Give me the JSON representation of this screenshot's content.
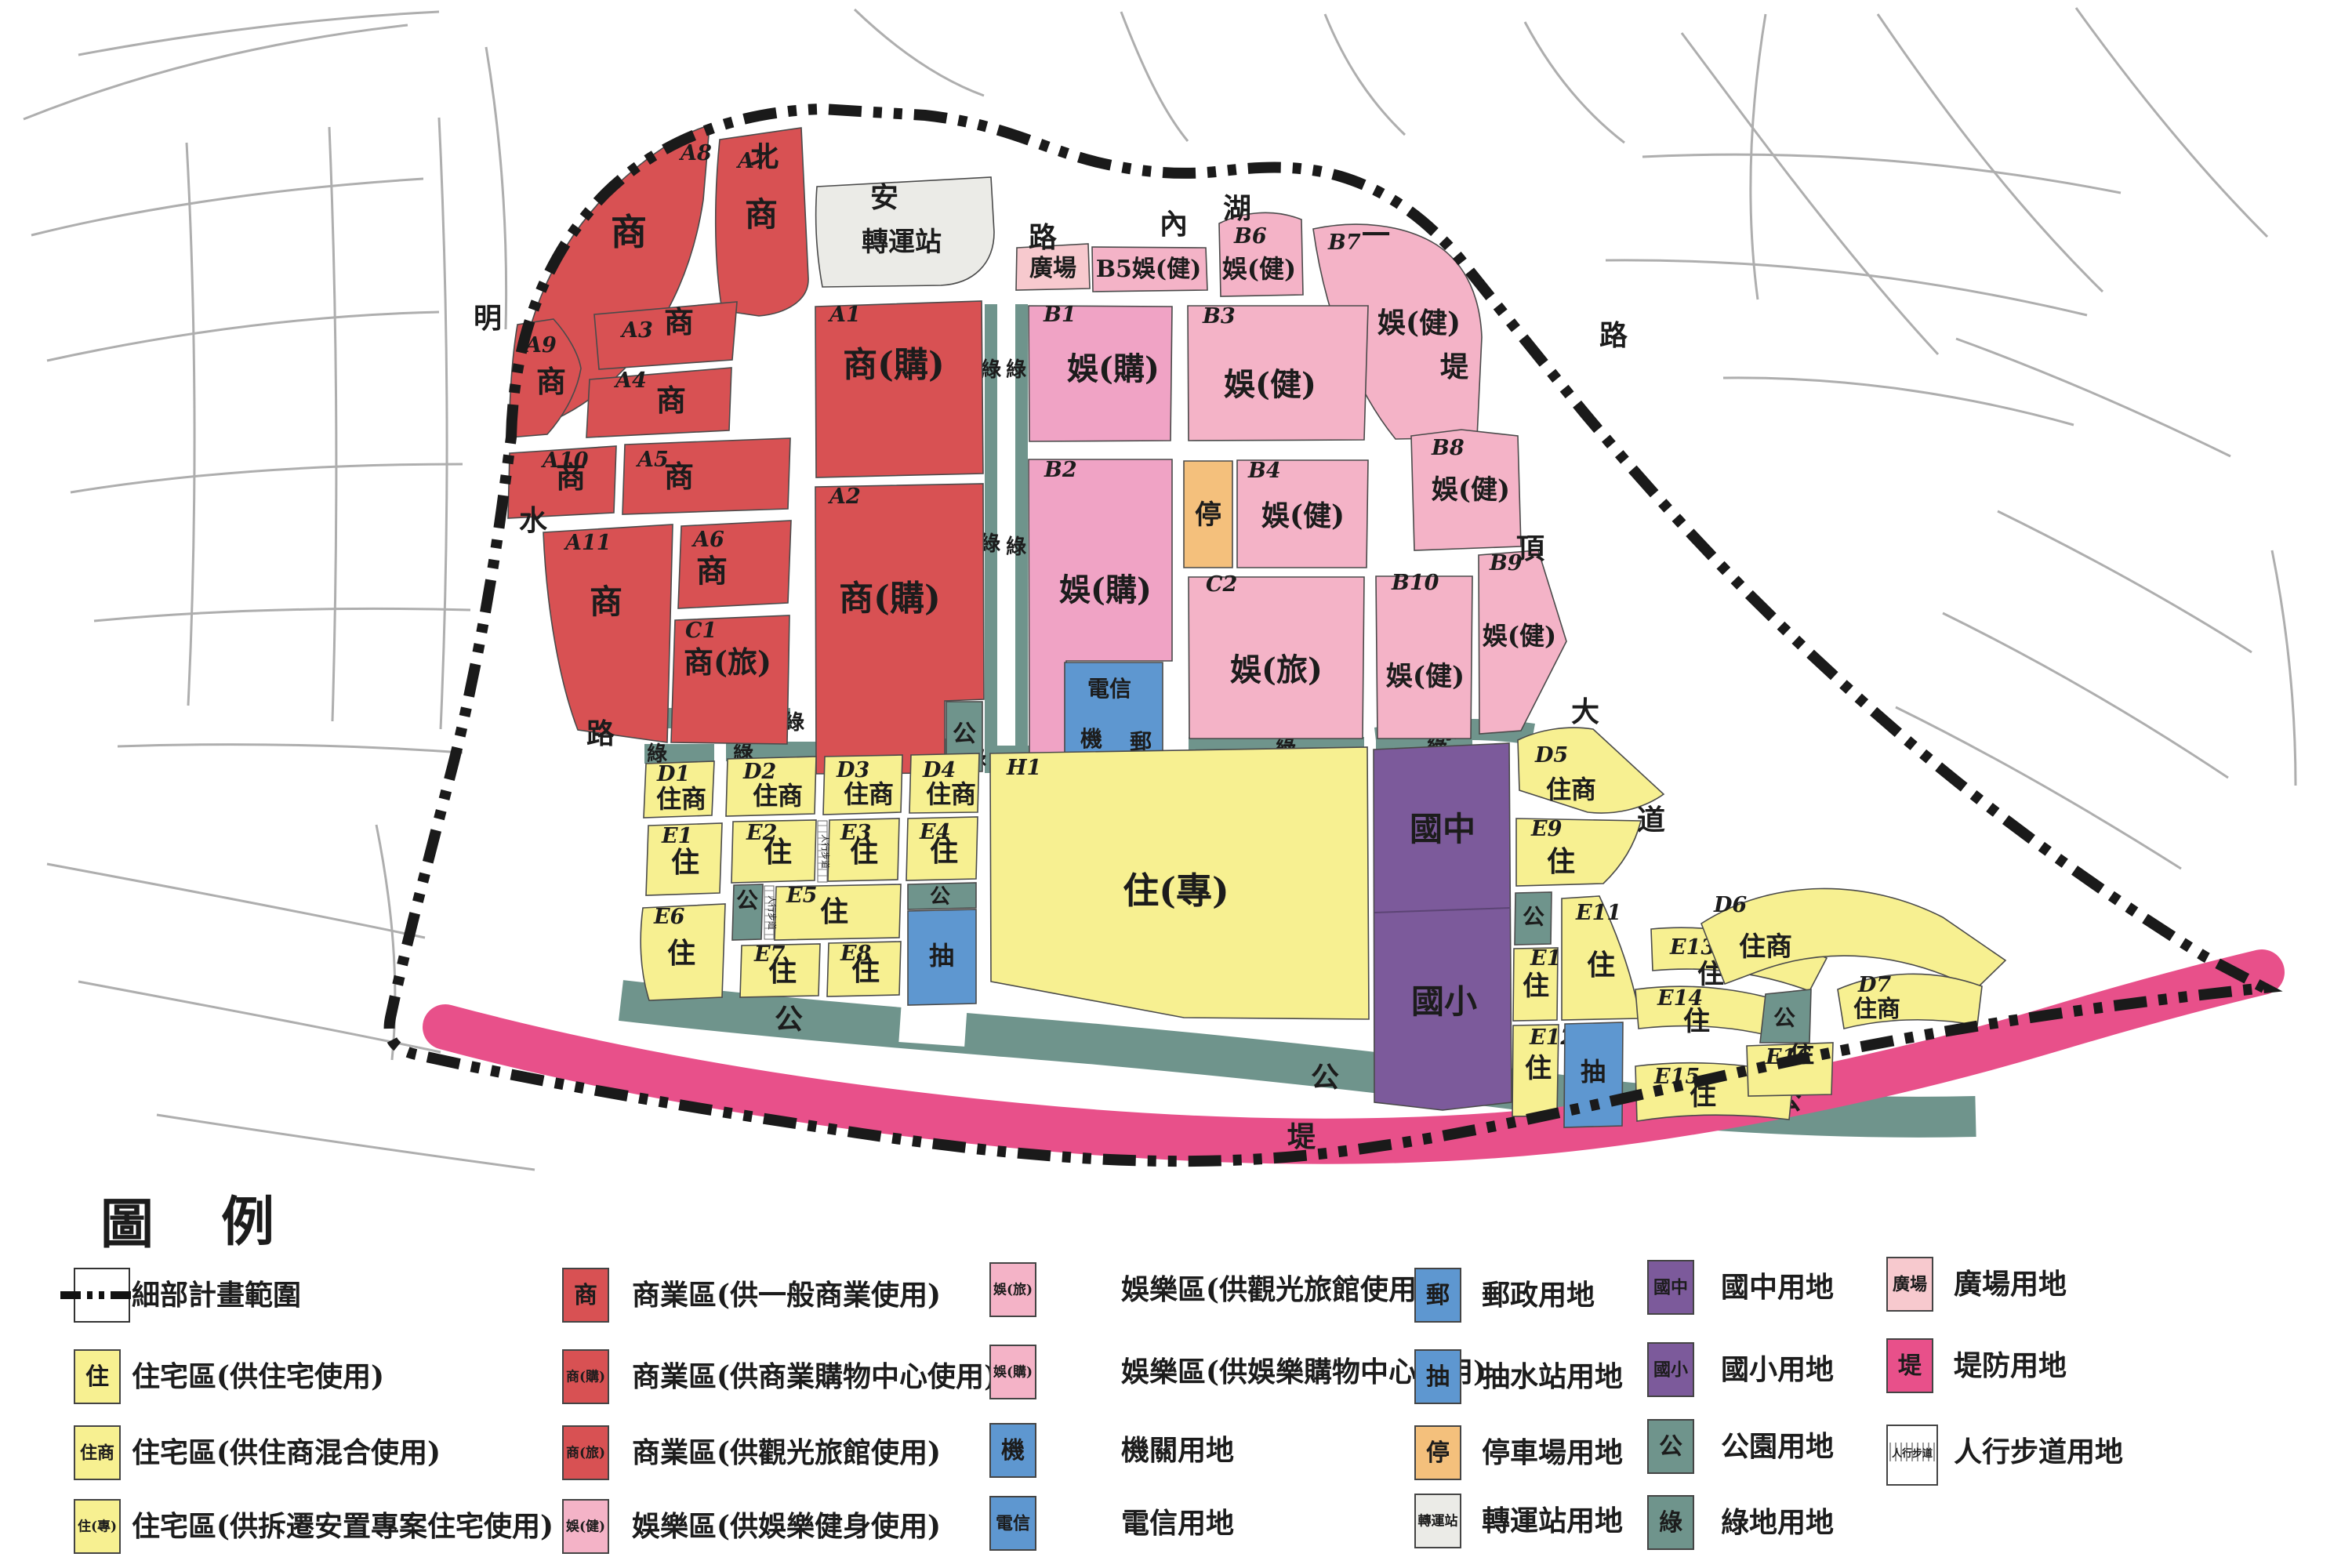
{
  "colors": {
    "commercial": "#d85153",
    "entertainment": "#f4b3c7",
    "entshop": "#f0a3c5",
    "plaza": "#f7c9ce",
    "residential": "#f7f091",
    "school": "#7c5a9b",
    "institution": "#5e97d0",
    "parking": "#f4c07c",
    "park": "#6f948c",
    "green": "#6f948c",
    "levee": "#e8508a",
    "station": "#ebebe7",
    "boundary": "#1a1a1a",
    "street": "#aeaeae"
  },
  "map": {
    "zones": [
      {
        "key": "A8",
        "id": "A8",
        "label": "商",
        "kind": "commercial"
      },
      {
        "key": "A7",
        "id": "A7",
        "label": "商",
        "kind": "commercial"
      },
      {
        "key": "A3",
        "id": "A3",
        "label": "商",
        "kind": "commercial"
      },
      {
        "key": "A9",
        "id": "A9",
        "label": "商",
        "kind": "commercial"
      },
      {
        "key": "A4",
        "id": "A4",
        "label": "商",
        "kind": "commercial"
      },
      {
        "key": "A10",
        "id": "A10",
        "label": "商",
        "kind": "commercial"
      },
      {
        "key": "A5",
        "id": "A5",
        "label": "商",
        "kind": "commercial"
      },
      {
        "key": "A11",
        "id": "A11",
        "label": "商",
        "kind": "commercial"
      },
      {
        "key": "A6",
        "id": "A6",
        "label": "商",
        "kind": "commercial"
      },
      {
        "key": "C1",
        "id": "C1",
        "label": "商(旅)",
        "kind": "commercial"
      },
      {
        "key": "A1",
        "id": "A1",
        "label": "商(購)",
        "kind": "commercial"
      },
      {
        "key": "A2",
        "id": "A2",
        "label": "商(購)",
        "kind": "commercial"
      },
      {
        "key": "ZS",
        "id": "",
        "label": "轉運站",
        "kind": "station"
      },
      {
        "key": "GC",
        "id": "",
        "label": "廣場",
        "kind": "plaza"
      },
      {
        "key": "B5",
        "id": "",
        "label": "B5娛(健)",
        "kind": "entertainment"
      },
      {
        "key": "B6",
        "id": "B6",
        "label": "娛(健)",
        "kind": "entertainment"
      },
      {
        "key": "B7",
        "id": "B7",
        "label": "娛(健)",
        "kind": "entertainment"
      },
      {
        "key": "B1",
        "id": "B1",
        "label": "娛(購)",
        "kind": "entshop"
      },
      {
        "key": "B3",
        "id": "B3",
        "label": "娛(健)",
        "kind": "entertainment"
      },
      {
        "key": "B2",
        "id": "B2",
        "label": "娛(購)",
        "kind": "entshop"
      },
      {
        "key": "P1",
        "id": "",
        "label": "停",
        "kind": "parking"
      },
      {
        "key": "B4",
        "id": "B4",
        "label": "娛(健)",
        "kind": "entertainment"
      },
      {
        "key": "B8",
        "id": "B8",
        "label": "娛(健)",
        "kind": "entertainment"
      },
      {
        "key": "C2",
        "id": "C2",
        "label": "娛(旅)",
        "kind": "entertainment"
      },
      {
        "key": "B10",
        "id": "B10",
        "label": "娛(健)",
        "kind": "entertainment"
      },
      {
        "key": "B9",
        "id": "B9",
        "label": "娛(健)",
        "kind": "entertainment"
      },
      {
        "key": "TEL",
        "id": "",
        "label": "電信",
        "label2": "機",
        "label3": "郵",
        "kind": "institution"
      },
      {
        "key": "PK1",
        "id": "",
        "label": "公",
        "kind": "park"
      },
      {
        "key": "SCH",
        "id": "",
        "label": "國中",
        "label2": "國小",
        "kind": "school"
      },
      {
        "key": "H1",
        "id": "H1",
        "label": "住(專)",
        "kind": "residential"
      },
      {
        "key": "D1",
        "id": "D1",
        "label": "住商",
        "kind": "residential"
      },
      {
        "key": "D2",
        "id": "D2",
        "label": "住商",
        "kind": "residential"
      },
      {
        "key": "D3",
        "id": "D3",
        "label": "住商",
        "kind": "residential"
      },
      {
        "key": "D4",
        "id": "D4",
        "label": "住商",
        "kind": "residential"
      },
      {
        "key": "E1",
        "id": "E1",
        "label": "住",
        "kind": "residential"
      },
      {
        "key": "E2",
        "id": "E2",
        "label": "住",
        "kind": "residential"
      },
      {
        "key": "E3",
        "id": "E3",
        "label": "住",
        "kind": "residential"
      },
      {
        "key": "E4",
        "id": "E4",
        "label": "住",
        "kind": "residential"
      },
      {
        "key": "PK2",
        "id": "",
        "label": "公",
        "kind": "park"
      },
      {
        "key": "E5",
        "id": "E5",
        "label": "住",
        "kind": "residential"
      },
      {
        "key": "E6",
        "id": "E6",
        "label": "住",
        "kind": "residential"
      },
      {
        "key": "E7",
        "id": "E7",
        "label": "住",
        "kind": "residential"
      },
      {
        "key": "E8",
        "id": "E8",
        "label": "住",
        "kind": "residential"
      },
      {
        "key": "PK3",
        "id": "",
        "label": "公",
        "kind": "park"
      },
      {
        "key": "CH1",
        "id": "",
        "label": "抽",
        "kind": "institution"
      },
      {
        "key": "D5",
        "id": "D5",
        "label": "住商",
        "kind": "residential"
      },
      {
        "key": "E9",
        "id": "E9",
        "label": "住",
        "kind": "residential"
      },
      {
        "key": "PK4",
        "id": "",
        "label": "公",
        "kind": "park"
      },
      {
        "key": "E10",
        "id": "E10",
        "label": "住",
        "kind": "residential"
      },
      {
        "key": "E11",
        "id": "E11",
        "label": "住",
        "kind": "residential"
      },
      {
        "key": "E12",
        "id": "E12",
        "label": "住",
        "kind": "residential"
      },
      {
        "key": "CH2",
        "id": "",
        "label": "抽",
        "kind": "institution"
      },
      {
        "key": "E13",
        "id": "E13",
        "label": "住",
        "kind": "residential"
      },
      {
        "key": "E14",
        "id": "E14",
        "label": "住",
        "kind": "residential"
      },
      {
        "key": "E15",
        "id": "E15",
        "label": "住",
        "kind": "residential"
      },
      {
        "key": "E16",
        "id": "E16",
        "label": "住",
        "kind": "residential"
      },
      {
        "key": "D6",
        "id": "D6",
        "label": "住商",
        "kind": "residential"
      },
      {
        "key": "D7",
        "id": "D7",
        "label": "住商",
        "kind": "residential"
      },
      {
        "key": "PK5",
        "id": "",
        "label": "公",
        "kind": "park"
      }
    ],
    "green_label": "綠",
    "band_labels": {
      "park1": "公",
      "park2": "公",
      "park3": "公",
      "levee": "堤"
    },
    "sidewalk_label": "人行步道",
    "road_labels": [
      "北",
      "安",
      "路",
      "內",
      "湖",
      "一",
      "路",
      "明",
      "水",
      "路",
      "堤",
      "頂",
      "大",
      "道"
    ]
  },
  "legend": {
    "title_left": "圖",
    "title_right": "例",
    "columns": [
      {
        "items": [
          {
            "kind": "boundaryline",
            "label": "",
            "desc": "細部計畫範圍"
          },
          {
            "kind": "residential",
            "label": "住",
            "desc": "住宅區(供住宅使用)"
          },
          {
            "kind": "residential",
            "label": "住商",
            "desc": "住宅區(供住商混合使用)"
          },
          {
            "kind": "residential",
            "label": "住(專)",
            "desc": "住宅區(供拆遷安置專案住宅使用)"
          }
        ]
      },
      {
        "items": [
          {
            "kind": "commercial",
            "label": "商",
            "desc": "商業區(供一般商業使用)"
          },
          {
            "kind": "commercial",
            "label": "商(購)",
            "desc": "商業區(供商業購物中心使用)"
          },
          {
            "kind": "commercial",
            "label": "商(旅)",
            "desc": "商業區(供觀光旅館使用)"
          },
          {
            "kind": "entertainment",
            "label": "娛(健)",
            "desc": "娛樂區(供娛樂健身使用)"
          }
        ]
      },
      {
        "items": [
          {
            "kind": "entertainment",
            "label": "娛(旅)",
            "desc": "娛樂區(供觀光旅館使用)"
          },
          {
            "kind": "entertainment",
            "label": "娛(購)",
            "desc": "娛樂區(供娛樂購物中心使用)"
          },
          {
            "kind": "institution",
            "label": "機",
            "desc": "機關用地"
          },
          {
            "kind": "institution",
            "label": "電信",
            "desc": "電信用地"
          }
        ]
      },
      {
        "items": [
          {
            "kind": "institution",
            "label": "郵",
            "desc": "郵政用地"
          },
          {
            "kind": "institution",
            "label": "抽",
            "desc": "抽水站用地"
          },
          {
            "kind": "parking",
            "label": "停",
            "desc": "停車場用地"
          },
          {
            "kind": "station",
            "label": "轉運站",
            "desc": "轉運站用地"
          }
        ]
      },
      {
        "items": [
          {
            "kind": "school",
            "label": "國中",
            "desc": "國中用地"
          },
          {
            "kind": "school",
            "label": "國小",
            "desc": "國小用地"
          },
          {
            "kind": "park",
            "label": "公",
            "desc": "公園用地"
          },
          {
            "kind": "park",
            "label": "綠",
            "desc": "綠地用地"
          }
        ]
      },
      {
        "items": [
          {
            "kind": "plaza",
            "label": "廣場",
            "desc": "廣場用地"
          },
          {
            "kind": "levee",
            "label": "堤",
            "desc": "堤防用地"
          },
          {
            "kind": "sidewalk",
            "label": "人行步道",
            "desc": "人行步道用地"
          }
        ]
      }
    ]
  }
}
